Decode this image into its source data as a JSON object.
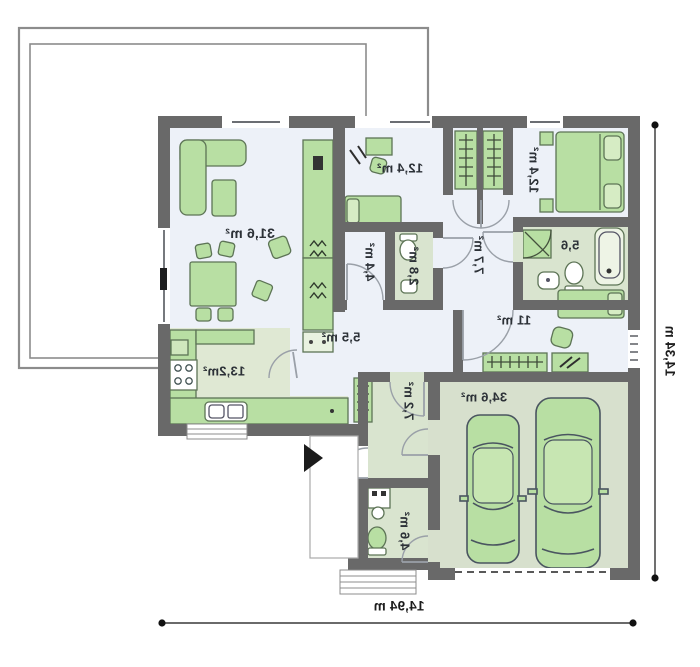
{
  "floorplan": {
    "mirrored": true,
    "rooms": {
      "living": "31,6 m²",
      "bedroom_top": "12,4 m²",
      "bedroom_right": "12,4 m²",
      "closet": "4,4 m²",
      "wc_small": "2,8 m²",
      "corridor": "7,7 m²",
      "bathroom": "5,6",
      "bedroom_side": "11 m²",
      "hall": "5,5 m²",
      "kitchen": "13,2m²",
      "entry_hall": "7,2 m²",
      "utility": "4,6 m²",
      "garage": "34,6 m²"
    },
    "dimensions": {
      "width": "14,94 m",
      "height": "14,34 m"
    },
    "colors": {
      "wall": "#696969",
      "floor_light": "#edf1f8",
      "floor_green": "#d9e4cf",
      "kitchen_floor": "#dfe8d3",
      "garage_floor": "#d7e0cd",
      "furniture": "#b8dfa3",
      "furniture_outline": "#5d7456",
      "terrace_line": "#8c8c8c",
      "dimension_line": "#111111"
    }
  }
}
